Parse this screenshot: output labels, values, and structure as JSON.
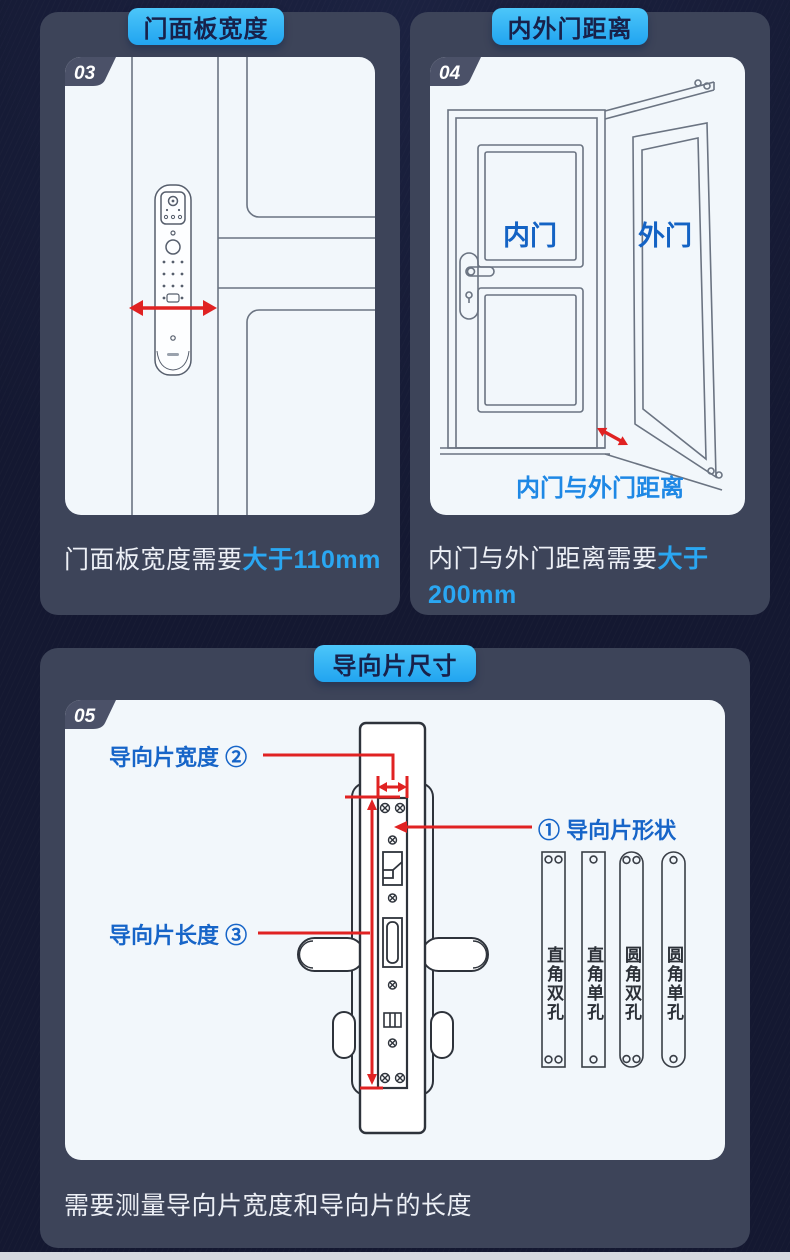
{
  "theme": {
    "background": "#141831",
    "panel": "#3d4459",
    "card": "#f2f7fb",
    "badge_gradient_top": "#4cc6f9",
    "badge_gradient_bottom": "#21a4f0",
    "badge_text": "#18214a",
    "step_tab": "#4b5168",
    "highlight_blue": "#2aa7f2",
    "diagram_label_blue": "#1463c4",
    "distance_caption_blue": "#1e88e5",
    "measure_red": "#e02222"
  },
  "sections": [
    {
      "badge": "门面板宽度",
      "step": "03",
      "caption_plain": "门面板宽度需要",
      "caption_highlight": "大于110mm"
    },
    {
      "badge": "内外门距离",
      "step": "04",
      "inner_door_label": "内门",
      "outer_door_label": "外门",
      "distance_label": "内门与外门距离",
      "caption_plain": "内门与外门距离需要",
      "caption_highlight": "大于",
      "caption_value": "200mm"
    },
    {
      "badge": "导向片尺寸",
      "step": "05",
      "width_label": "导向片宽度 ②",
      "shape_label": "① 导向片形状",
      "length_label": "导向片长度 ③",
      "plate_types": [
        "直角双孔",
        "直角单孔",
        "圆角双孔",
        "圆角单孔"
      ],
      "caption": "需要测量导向片宽度和导向片的长度"
    }
  ]
}
